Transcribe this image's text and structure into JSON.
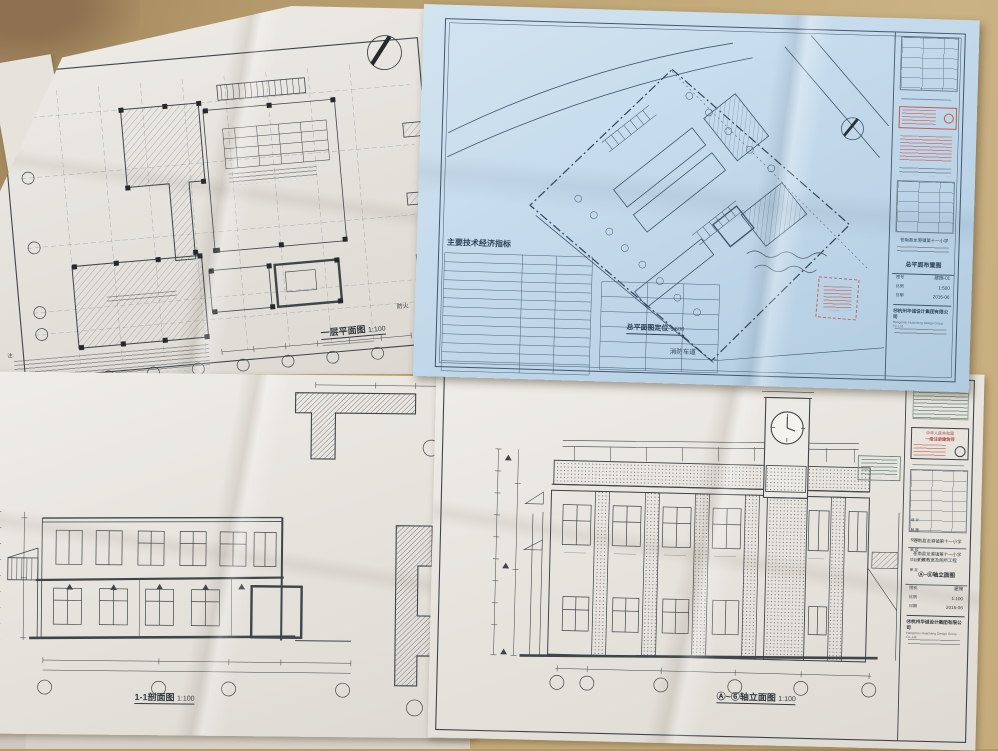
{
  "colors": {
    "floor": "#b49a6b",
    "floor_dark": "#8d7150",
    "paper": "#eae7e1",
    "blueprint_paper": "#c5dbec",
    "ink": "#3a4046",
    "blue_ink": "#41586c",
    "stamp_red": "#c2544e",
    "stamp_green": "#5f7f6e"
  },
  "sheets": {
    "floor_plan": {
      "title": "一层平面图",
      "scale": "1:100",
      "notes_label": "注:",
      "partial_label": "防火"
    },
    "site_plan": {
      "indicators_heading": "主要技术经济指标",
      "caption": "总平面图定位",
      "caption_scale": "1:500",
      "road_label": "消防车道",
      "title_block": {
        "project": "苍南县龙港镇第十一小学",
        "drawing_name": "总平面布置图",
        "no_label": "图号",
        "drawing_no": "建施-01",
        "scale_label": "比例",
        "scale": "1:500",
        "date_label": "日期",
        "date": "2016-06",
        "company": "杭州华诚设计集团有限公司",
        "company_en": "Hangzhou Huacheng Design Group Co.,Ltd."
      }
    },
    "section": {
      "title": "1-1剖面图",
      "scale": "1:100"
    },
    "elevation": {
      "title": "Ⓐ~⑥轴立面图",
      "scale": "1:100",
      "title_block": {
        "stamp_country": "中华人民共和国",
        "stamp_cert": "一级注册建筑师",
        "sign_rows": [
          "设 计",
          "制 图",
          "校 对",
          "审 核",
          "项目负责",
          "审 定"
        ],
        "project": "苍南县龙港镇第十一小学",
        "project_line2": "扩建教室及厕所工程",
        "drawing_name": "Ⓐ~⑥轴立面图",
        "category_label": "图别",
        "category": "建施",
        "scale_label": "比例",
        "scale": "1:100",
        "date_label": "日期",
        "date": "2016-06",
        "company": "杭州华诚设计集团有限公司",
        "company_en": "Hangzhou Huacheng Design Group Co.,Ltd."
      }
    }
  }
}
